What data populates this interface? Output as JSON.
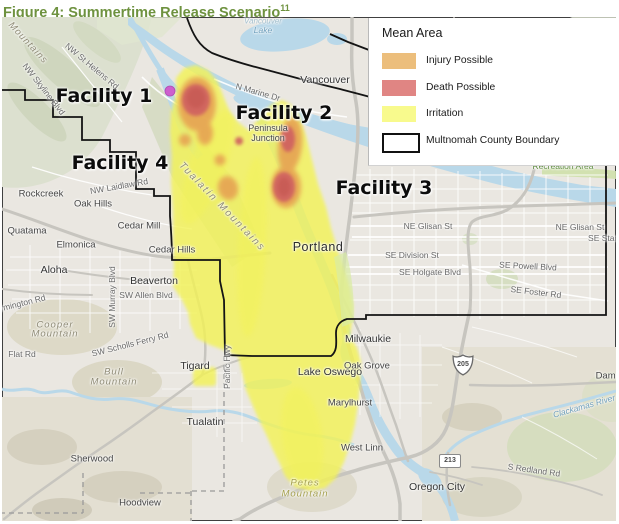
{
  "title": {
    "text": "Figure 4: Summertime Release Scenario",
    "superscript": "11",
    "color": "#6e923f"
  },
  "legend": {
    "title": "Mean Area",
    "items": [
      {
        "label": "Injury Possible",
        "color": "#ecbe7c",
        "type": "fill"
      },
      {
        "label": "Death Possible",
        "color": "#e08583",
        "type": "fill"
      },
      {
        "label": "Irritation",
        "color": "#f8fa8d",
        "type": "fill"
      },
      {
        "label": "Multnomah County Boundary",
        "color": "#111111",
        "type": "outline"
      }
    ]
  },
  "map": {
    "plume_colors": {
      "irritation": "#f3f354",
      "injury": "#e6a452",
      "death": "#d06360",
      "death_core": "#c2554f"
    },
    "marker_color": "#cd5fce",
    "shields": {
      "interstate": "205",
      "route": "213"
    },
    "labels": [
      {
        "t": "Facility 1",
        "x": 102,
        "y": 79,
        "c": "facility"
      },
      {
        "t": "Facility 2",
        "x": 282,
        "y": 96,
        "c": "facility"
      },
      {
        "t": "Facility 3",
        "x": 382,
        "y": 171,
        "c": "facility"
      },
      {
        "t": "Facility 4",
        "x": 118,
        "y": 146,
        "c": "facility"
      },
      {
        "t": "Vancouver",
        "x": 323,
        "y": 63,
        "c": "city"
      },
      {
        "t": "Portland",
        "x": 316,
        "y": 230,
        "c": "city-lg"
      },
      {
        "t": "Beaverton",
        "x": 152,
        "y": 264,
        "c": "city"
      },
      {
        "t": "Aloha",
        "x": 52,
        "y": 253,
        "c": "city"
      },
      {
        "t": "Tigard",
        "x": 193,
        "y": 349,
        "c": "city"
      },
      {
        "t": "Tualatin",
        "x": 203,
        "y": 405,
        "c": "city"
      },
      {
        "t": "Lake Oswego",
        "x": 328,
        "y": 355,
        "c": "city"
      },
      {
        "t": "Milwaukie",
        "x": 366,
        "y": 322,
        "c": "city"
      },
      {
        "t": "Oregon City",
        "x": 435,
        "y": 470,
        "c": "city"
      },
      {
        "t": "Rockcreek",
        "x": 39,
        "y": 177,
        "c": "town"
      },
      {
        "t": "Oak Hills",
        "x": 91,
        "y": 187,
        "c": "town"
      },
      {
        "t": "Cedar Mill",
        "x": 137,
        "y": 209,
        "c": "town"
      },
      {
        "t": "Quatama",
        "x": 25,
        "y": 214,
        "c": "town"
      },
      {
        "t": "Elmonica",
        "x": 74,
        "y": 228,
        "c": "town"
      },
      {
        "t": "Cedar Hills",
        "x": 170,
        "y": 233,
        "c": "town"
      },
      {
        "t": "Oak Grove",
        "x": 365,
        "y": 349,
        "c": "town"
      },
      {
        "t": "Marylhurst",
        "x": 348,
        "y": 386,
        "c": "town"
      },
      {
        "t": "West Linn",
        "x": 360,
        "y": 431,
        "c": "town"
      },
      {
        "t": "Sherwood",
        "x": 90,
        "y": 442,
        "c": "town"
      },
      {
        "t": "Hoodview",
        "x": 138,
        "y": 486,
        "c": "town"
      },
      {
        "t": "Damascus",
        "x": 616,
        "y": 359,
        "c": "town"
      },
      {
        "t": "Peninsula",
        "x": 266,
        "y": 111,
        "c": "town",
        "s": 9
      },
      {
        "t": "Junction",
        "x": 266,
        "y": 121,
        "c": "town",
        "s": 9
      },
      {
        "t": "NW St Helens Rd",
        "x": 90,
        "y": 49,
        "c": "road",
        "r": 40
      },
      {
        "t": "NW Skyline Blvd",
        "x": 42,
        "y": 72,
        "c": "road",
        "r": 52
      },
      {
        "t": "NW Laidlaw Rd",
        "x": 117,
        "y": 169,
        "c": "road",
        "r": -10
      },
      {
        "t": "N Marine Dr",
        "x": 256,
        "y": 75,
        "c": "road",
        "r": 16
      },
      {
        "t": "SW Murray Blvd",
        "x": 110,
        "y": 280,
        "c": "road",
        "r": -90
      },
      {
        "t": "SW Allen Blvd",
        "x": 144,
        "y": 278,
        "c": "road"
      },
      {
        "t": "Farmington Rd",
        "x": 16,
        "y": 287,
        "c": "road",
        "r": -14
      },
      {
        "t": "SW Scholls Ferry Rd",
        "x": 128,
        "y": 327,
        "c": "road",
        "r": -14
      },
      {
        "t": "Flat Rd",
        "x": 20,
        "y": 337,
        "c": "road"
      },
      {
        "t": "Pacific Hwy",
        "x": 225,
        "y": 350,
        "c": "road",
        "r": -90
      },
      {
        "t": "NE Glisan St",
        "x": 426,
        "y": 209,
        "c": "road"
      },
      {
        "t": "NE Glisan St",
        "x": 578,
        "y": 210,
        "c": "road"
      },
      {
        "t": "SE Stark St",
        "x": 608,
        "y": 221,
        "c": "road"
      },
      {
        "t": "SE Division St",
        "x": 410,
        "y": 238,
        "c": "road"
      },
      {
        "t": "SE Powell Blvd",
        "x": 526,
        "y": 249,
        "c": "road",
        "r": 3
      },
      {
        "t": "SE Holgate Blvd",
        "x": 428,
        "y": 255,
        "c": "road"
      },
      {
        "t": "SE Foster Rd",
        "x": 534,
        "y": 275,
        "c": "road",
        "r": 7
      },
      {
        "t": "S Redland Rd",
        "x": 532,
        "y": 453,
        "c": "road",
        "r": 8
      },
      {
        "t": "Recreation Area",
        "x": 561,
        "y": 149,
        "c": "green-label"
      },
      {
        "t": "Mountains",
        "x": 26,
        "y": 26,
        "c": "terrain",
        "r": 47
      },
      {
        "t": "Tualatin Mountains",
        "x": 220,
        "y": 190,
        "c": "terrain-lg",
        "r": 46
      },
      {
        "t": "Cooper",
        "x": 53,
        "y": 308,
        "c": "terrain"
      },
      {
        "t": "Mountain",
        "x": 53,
        "y": 317,
        "c": "terrain"
      },
      {
        "t": "Bull",
        "x": 112,
        "y": 355,
        "c": "terrain"
      },
      {
        "t": "Mountain",
        "x": 112,
        "y": 365,
        "c": "terrain"
      },
      {
        "t": "Petes",
        "x": 303,
        "y": 466,
        "c": "olive"
      },
      {
        "t": "Mountain",
        "x": 303,
        "y": 477,
        "c": "olive"
      },
      {
        "t": "Vancouver",
        "x": 261,
        "y": 4,
        "c": "water-faint"
      },
      {
        "t": "Lake",
        "x": 261,
        "y": 13,
        "c": "water"
      },
      {
        "t": "Clackamas River",
        "x": 582,
        "y": 389,
        "c": "water",
        "r": -16
      }
    ]
  }
}
